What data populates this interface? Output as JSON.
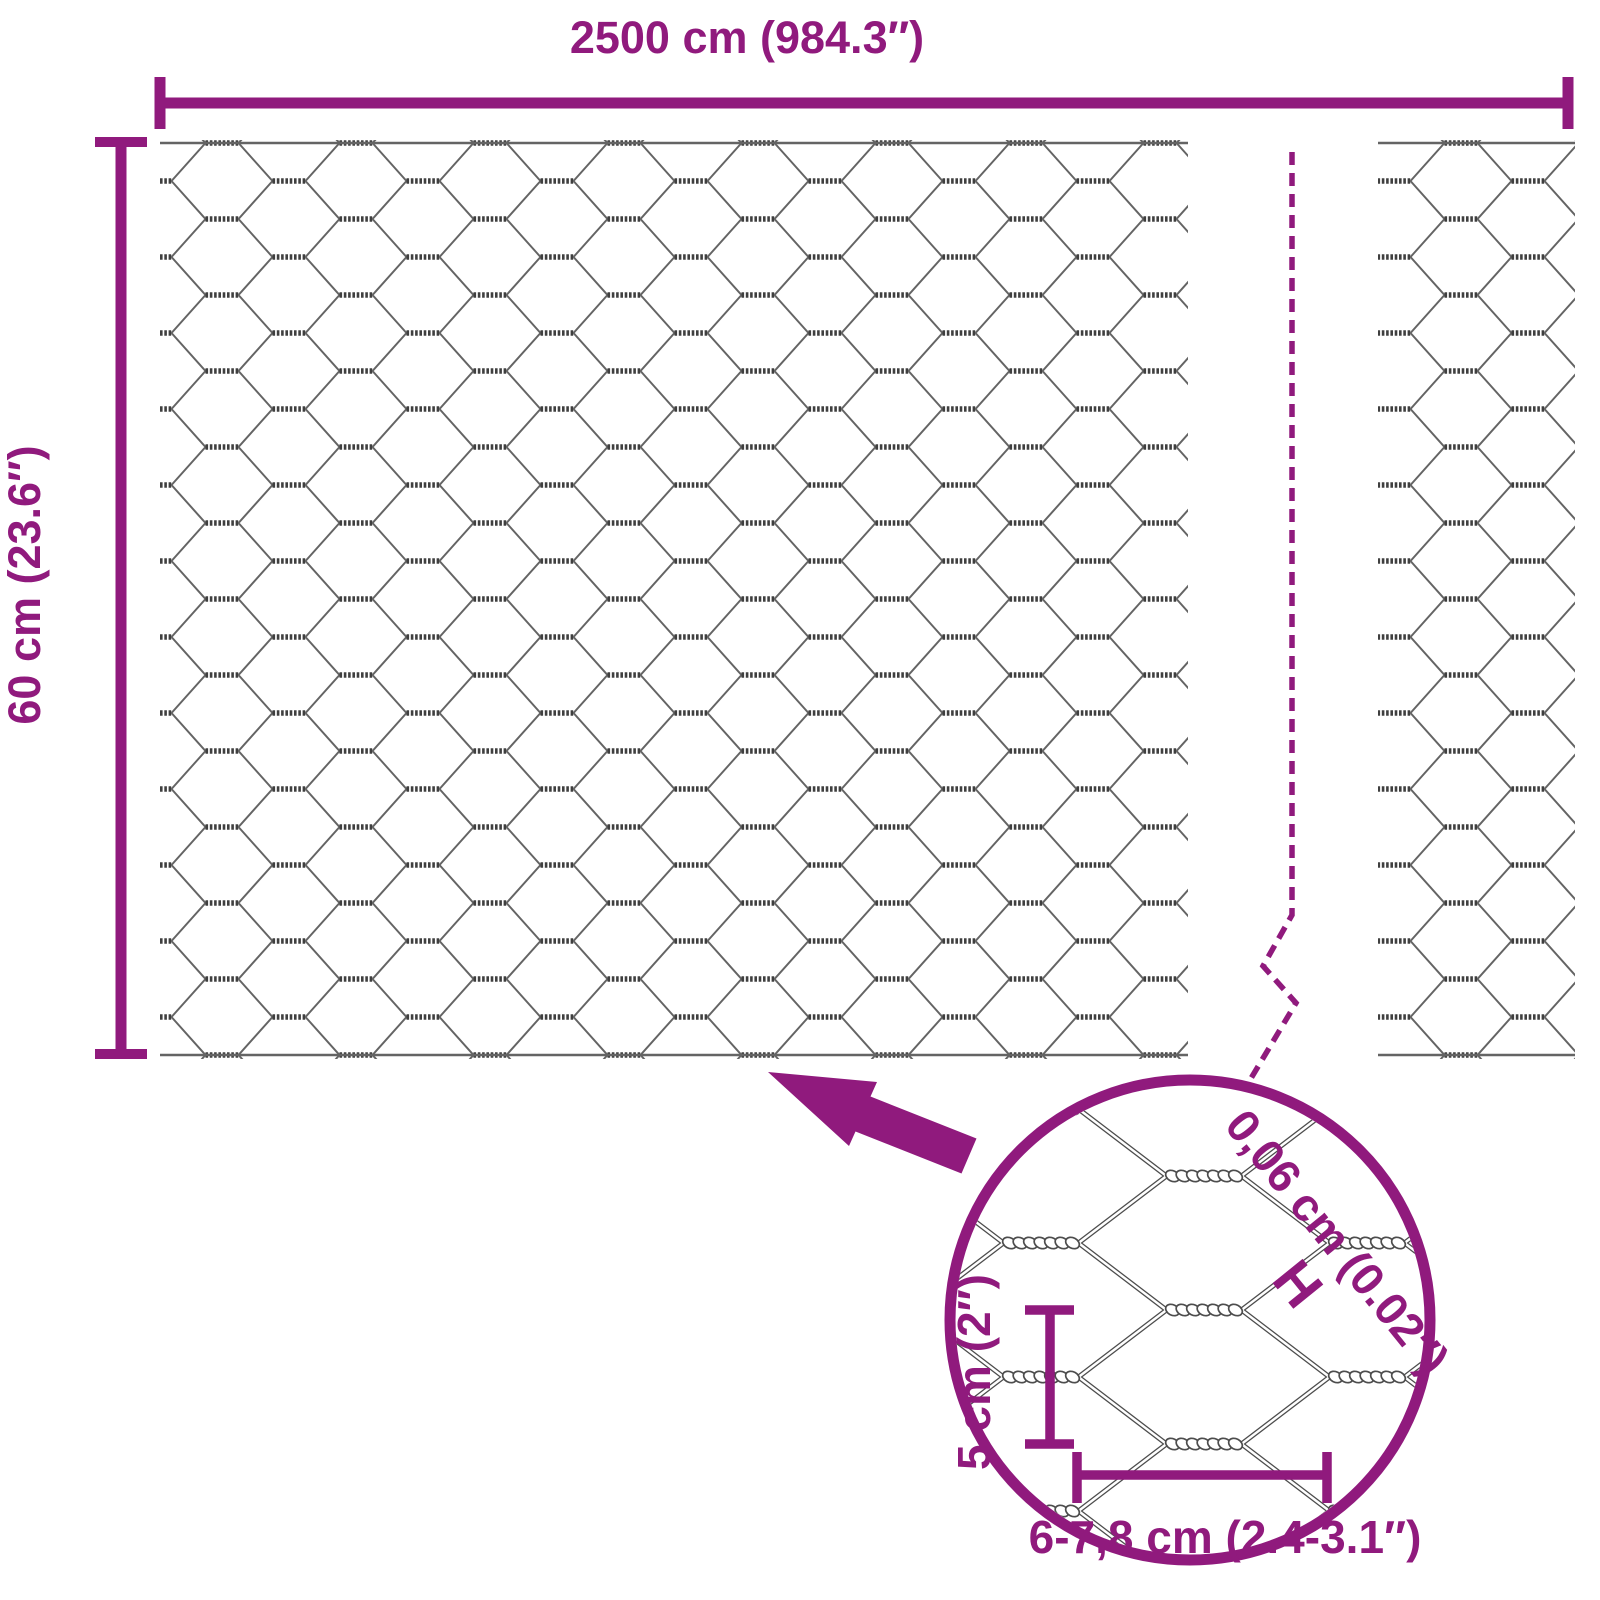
{
  "diagram": {
    "total_width_label": "2500 cm (984.3″)",
    "roll_height_label": "60 cm (23.6″)",
    "detail_labels": {
      "wire_thickness": "0,06 cm (0.02″)",
      "wire_thickness_marker": "H",
      "mesh_height": "5 cm (2″)",
      "mesh_width": "6-7,8 cm (2.4-3.1″)"
    },
    "colors": {
      "accent": "#901A7D",
      "wire": "#646464",
      "wire_dark": "#3F3F3F",
      "detail_wire": "#4D4D4D"
    }
  }
}
